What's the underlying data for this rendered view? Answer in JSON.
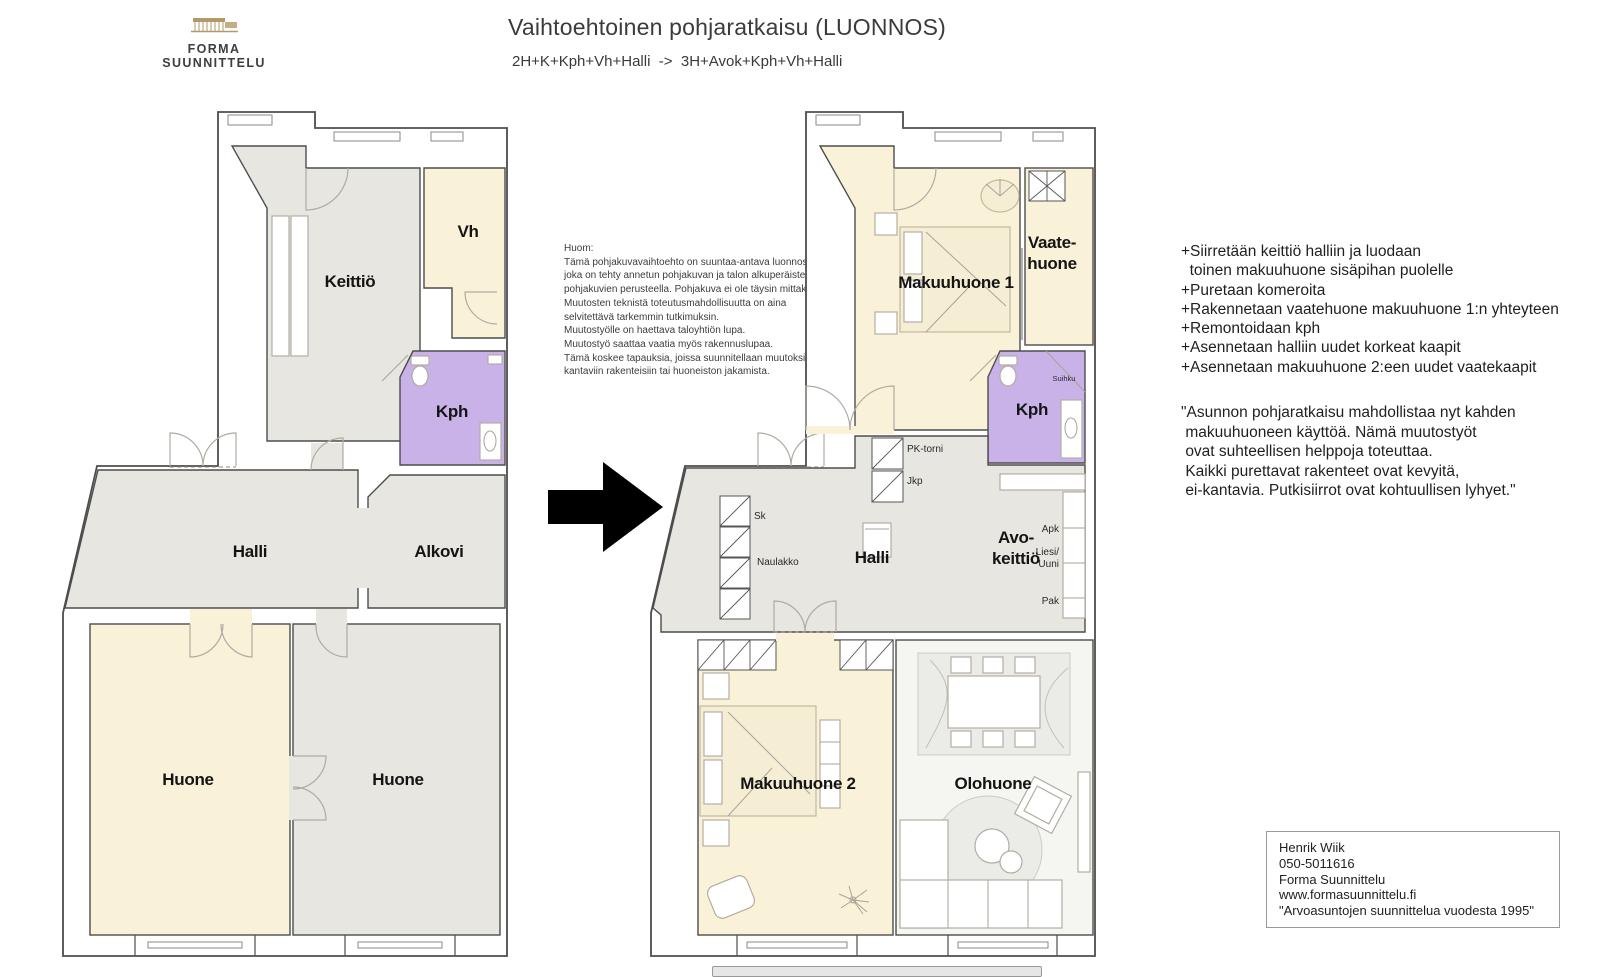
{
  "header": {
    "logo_text": "FORMA SUUNNITTELU",
    "title": "Vaihtoehtoinen pohjaratkaisu (LUONNOS)",
    "subtitle": "2H+K+Kph+Vh+Halli  ->  3H+Avok+Kph+Vh+Halli"
  },
  "note": {
    "text": "Huom:\nTämä pohjakuvavaihtoehto on suuntaa-antava luonnos,\njoka on tehty annetun pohjakuvan ja talon alkuperäisten\npohjakuvien perusteella. Pohjakuva ei ole täysin mittakaavassa.\nMuutosten teknistä toteutusmahdollisuutta on aina\nselvitettävä tarkemmin tutkimuksin.\nMuutostyölle on haettava taloyhtiön lupa.\nMuutostyö saattaa vaatia myös rakennuslupaa.\nTämä koskee tapauksia, joissa suunnitellaan muutoksia\nkantaviin rakenteisiin tai huoneiston jakamista."
  },
  "changes": {
    "text": "+Siirretään keittiö halliin ja luodaan\n  toinen makuuhuone sisäpihan puolelle\n+Puretaan komeroita\n+Rakennetaan vaatehuone makuuhuone 1:n yhteyteen\n+Remontoidaan kph\n+Asennetaan halliin uudet korkeat kaapit\n+Asennetaan makuuhuone 2:een uudet vaatekaapit"
  },
  "quote": {
    "text": "\"Asunnon pohjaratkaisu mahdollistaa nyt kahden\n makuuhuoneen käyttöä. Nämä muutostyöt\n ovat suhteellisen helppoja toteuttaa.\n Kaikki purettavat rakenteet ovat kevyitä,\n ei-kantavia. Putkisiirrot ovat kohtuullisen lyhyet.\""
  },
  "contact": {
    "text": "Henrik Wiik\n050-5011616\nForma Suunnittelu\nwww.formasuunnittelu.fi\n\"Arvoasuntojen suunnittelua vuodesta 1995\""
  },
  "plan_before": {
    "name": "Pohjakuva ennen",
    "rooms": {
      "keittio": "Keittiö",
      "vh": "Vh",
      "kph": "Kph",
      "halli": "Halli",
      "alkovi": "Alkovi",
      "huone_left": "Huone",
      "huone_right": "Huone"
    }
  },
  "plan_after": {
    "name": "Pohjakuva jälkeen",
    "rooms": {
      "makuuhuone1": "Makuuhuone 1",
      "vaatehuone1": "Vaate-",
      "vaatehuone2": "huone",
      "kph": "Kph",
      "halli": "Halli",
      "avokeittio1": "Avo-",
      "avokeittio2": "keittiö",
      "makuuhuone2": "Makuuhuone 2",
      "olohuone": "Olohuone"
    },
    "labels": {
      "pk_torni": "PK-torni",
      "jkp": "Jkp",
      "sk": "Sk",
      "naulakko": "Naulakko",
      "apk": "Apk",
      "liesi": "Liesi/",
      "uuni": "Uuni",
      "pak": "Pak",
      "suihku": "Suihku"
    }
  },
  "icons": {
    "transformation_arrow": "right-arrow",
    "logo_building": "building"
  },
  "colors": {
    "room_gray": "#e7e6e1",
    "room_cream": "#faf2d8",
    "room_purple": "#c9b2e8",
    "room_light": "#f5f5f2",
    "wall": "#4d4d4d",
    "furniture_line": "#b3ada3",
    "logo_tan": "#b5986a",
    "text": "#1f1f1f"
  }
}
